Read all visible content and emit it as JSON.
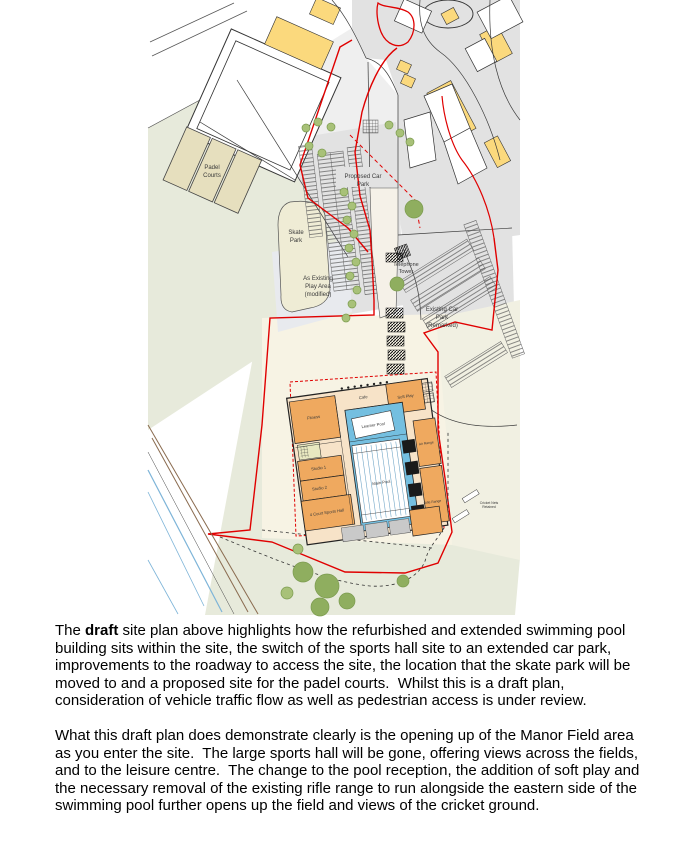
{
  "plan": {
    "colors": {
      "field_green": "#e7eadb",
      "site_cream": "#f7f3e4",
      "road_grey": "#e2e2e2",
      "building_yellow": "#fbd97d",
      "courts_beige": "#e6dfbe",
      "orange_block": "#efa95f",
      "pool_blue": "#74bfe0",
      "boundary_red": "#e00000",
      "tree_green": "#a8c178"
    },
    "labels": {
      "padel_courts": [
        "Padel",
        "Courts"
      ],
      "skate_park": [
        "Skate",
        "Park"
      ],
      "play_area": [
        "As Existing",
        "Play Area",
        "(modified)"
      ],
      "proposed_car_park": [
        "Proposed Car",
        "Park"
      ],
      "telephone_tower": [
        "Telephone",
        "Tower"
      ],
      "existing_car_park": [
        "Existing Car",
        "Park",
        "(Remarked)"
      ],
      "fitness": "Fitness",
      "cafe": "Cafe",
      "soft_play": "Soft Play",
      "studio_1": "Studio 1",
      "studio_2": "Studio 2",
      "sports_hall": "4 Court Sports Hall",
      "learner_pool": "Learner Pool",
      "main_pool": "Main Pool",
      "air_range": "Air Range",
      "rifle_range": "Rifle Range",
      "nets_note": [
        "Cricket Nets",
        "Retained"
      ]
    }
  },
  "body_text": {
    "paragraph_1": {
      "before_bold": "The ",
      "bold": "draft",
      "after_bold": " site plan above highlights how the refurbished and extended swimming pool building sits within the site, the switch of the sports hall site to an extended car park, improvements to the roadway to access the site, the location that the skate park will be moved to and a proposed site for the padel courts.  Whilst this is a draft plan, consideration of vehicle traffic flow as well as pedestrian access is under review."
    },
    "paragraph_2": "What this draft plan does demonstrate clearly is the opening up of the Manor Field area as you enter the site.  The large sports hall will be gone, offering views across the fields, and to the leisure centre.  The change to the pool reception, the addition of soft play and the necessary removal of the existing rifle range to run alongside the eastern side of the swimming pool further opens up the field and views of the cricket ground."
  }
}
